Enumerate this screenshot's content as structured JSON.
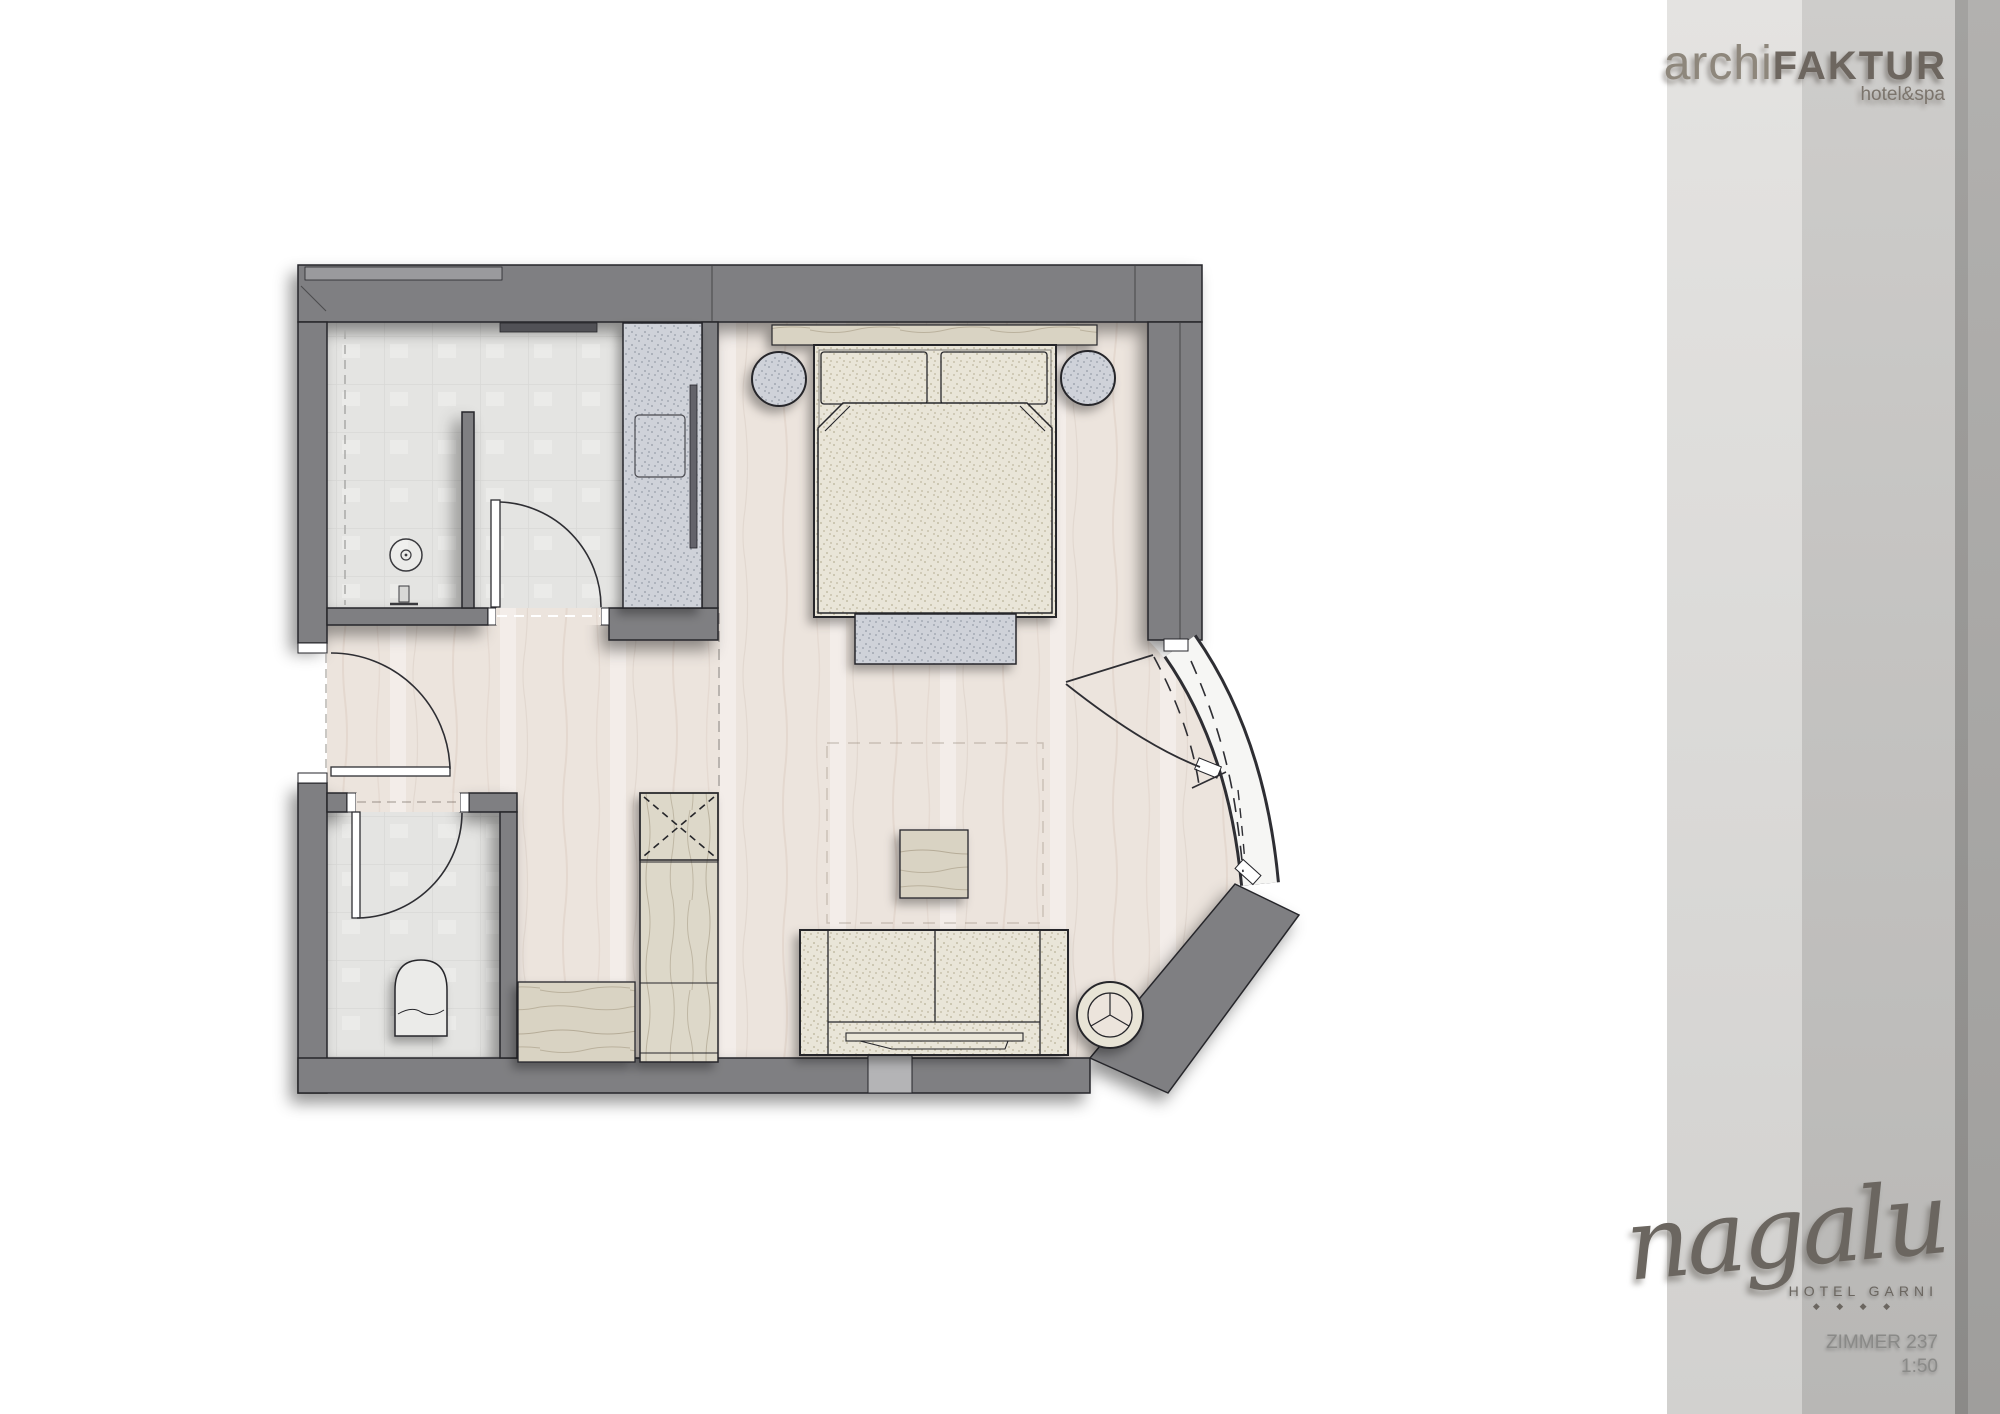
{
  "branding_top": {
    "brand_light": "archi",
    "brand_bold": "FAKTUR",
    "tagline": "hotel&spa"
  },
  "branding_bottom": {
    "logo_text": "nagalu",
    "subtitle": "HOTEL GARNI",
    "stars": "◆ ◆ ◆ ◆"
  },
  "title_block": {
    "room": "ZIMMER 237",
    "scale": "1:50"
  },
  "colors": {
    "wall": "#7f7f82",
    "wall_outline": "#26262b",
    "wood_floor": "#ece4dd",
    "tile_floor": "#e4e4e2",
    "fabric_cream": "#e9e5d8",
    "furniture_gray": "#cfd2d9",
    "wood_furniture": "#d9d3c3",
    "glazing": "#f6f6f4",
    "sidebar_light": "#dcdbd9",
    "sidebar_mid": "#c2c1bf",
    "sidebar_dark": "#979691",
    "logo_gray": "#6b6660",
    "label_gray": "#8a8a88"
  },
  "plan": {
    "rooms": [
      "bathroom",
      "wc",
      "entry-hall",
      "bedroom",
      "curved-window-bay"
    ],
    "furniture": [
      "double-bed",
      "pillows",
      "duvet",
      "foot-bench",
      "bedside-stool-left",
      "bedside-stool-right",
      "headboard-shelf",
      "wardrobe",
      "tall-cabinet",
      "luggage-bench",
      "side-table",
      "sofa",
      "round-ottoman",
      "toilet",
      "shower-drain",
      "entry-door",
      "bathroom-door",
      "wc-door",
      "bay-door"
    ]
  }
}
